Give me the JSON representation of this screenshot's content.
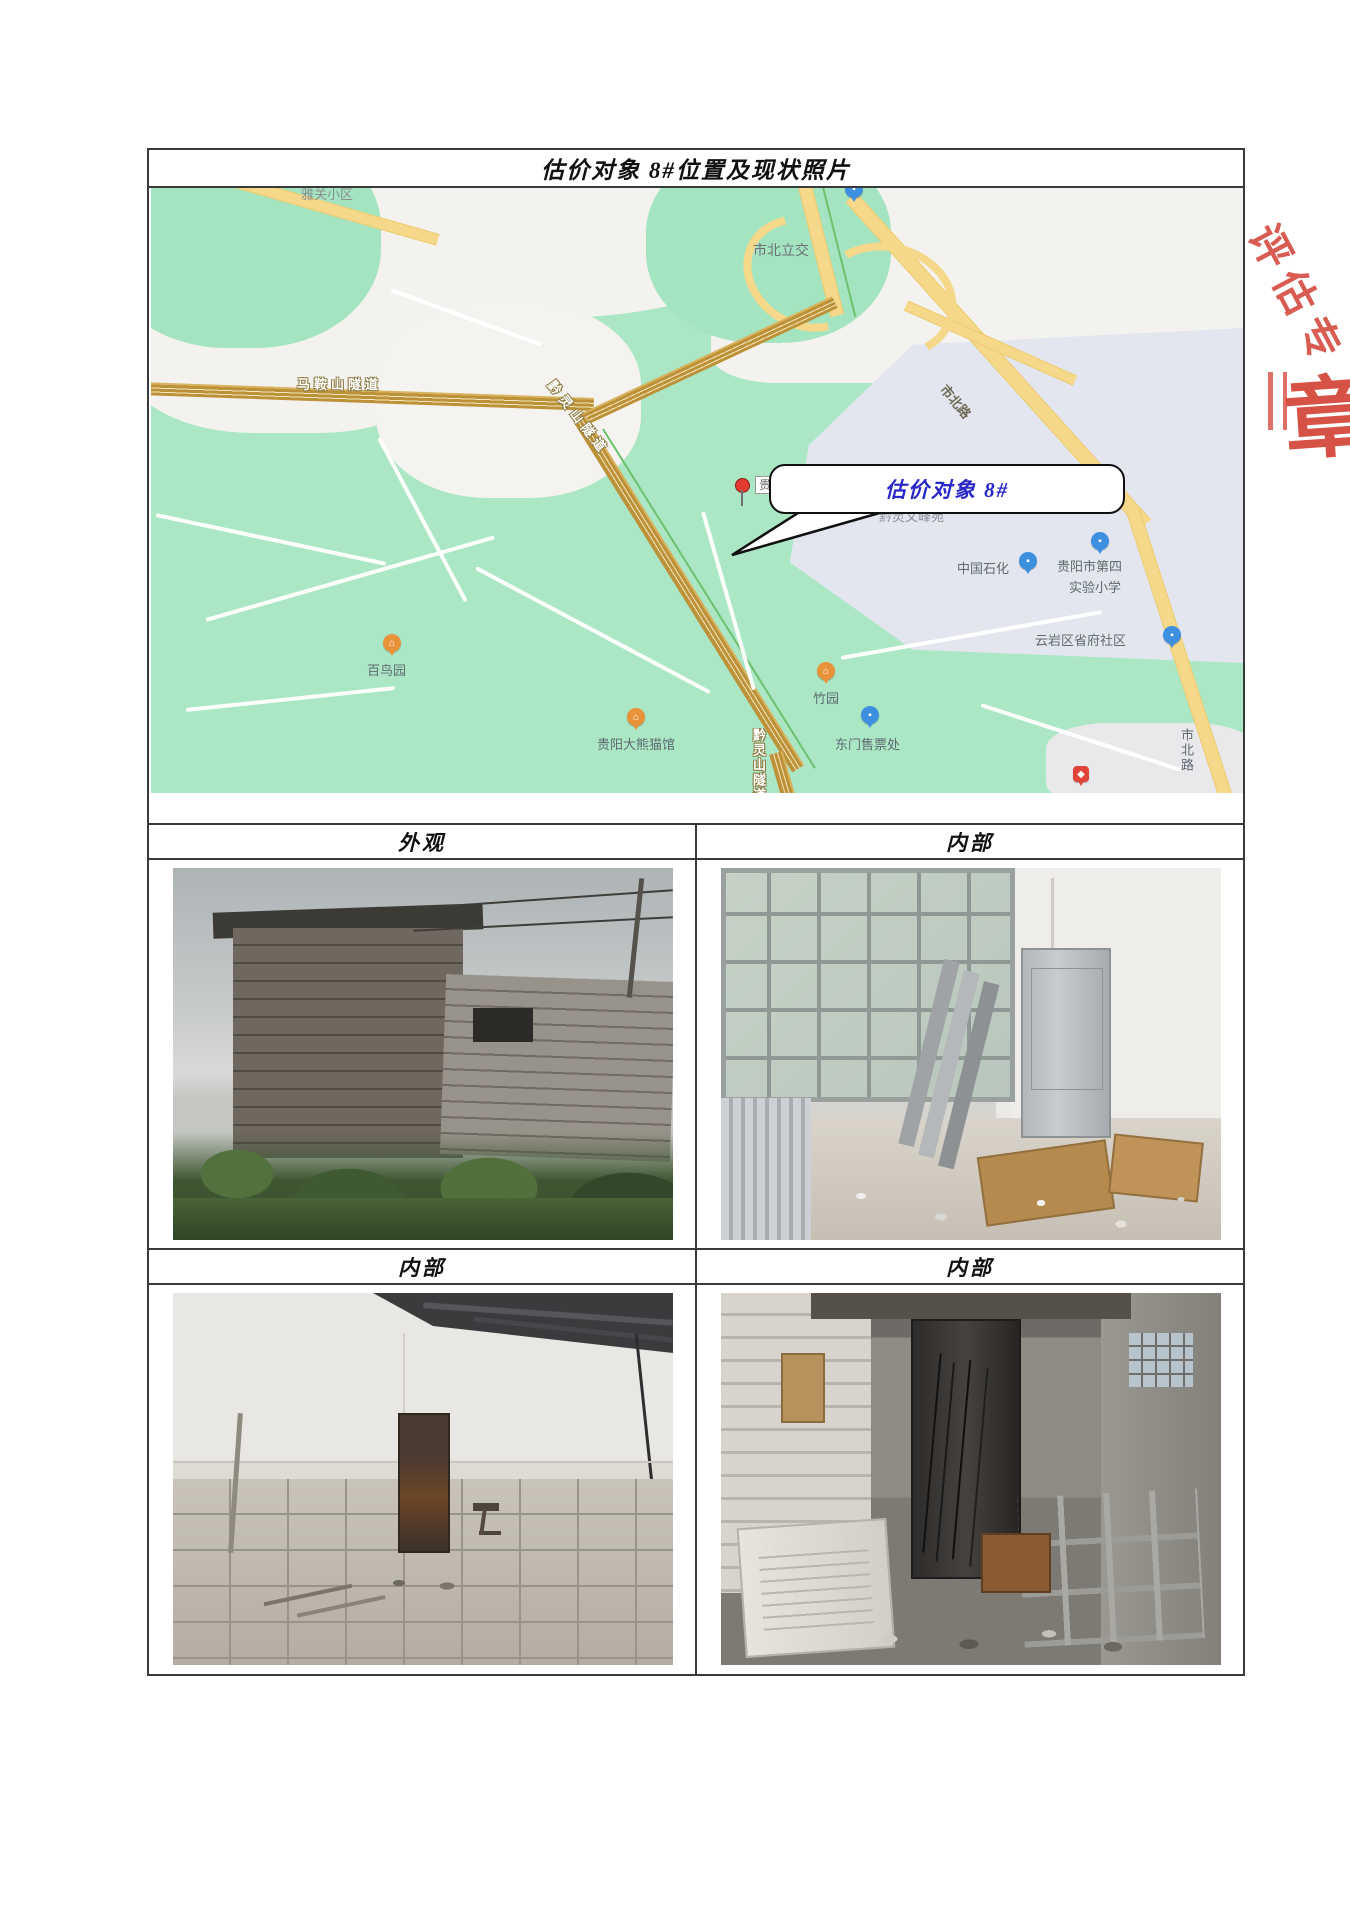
{
  "page": {
    "title": "估价对象 8#位置及现状照片"
  },
  "map": {
    "callout_text": "估价对象 8#",
    "pin_partial_label": "贵",
    "labels": {
      "yaguan": "雅关小区",
      "shibei_lijiao": "市北立交",
      "maanshan_tunnel": "马鞍山隧道",
      "qianlingshan_tunnel": "黔灵山隧道",
      "shibei_road_upper": "市北路",
      "qianling_wenfengyuan": "黔灵文峰苑",
      "sinopec": "中国石化",
      "school_line1": "贵阳市第四",
      "school_line2": "实验小学",
      "shengfu_community": "云岩区省府社区",
      "bainiaoyuan": "百鸟园",
      "zhuyuan": "竹园",
      "panda_house": "贵阳大熊猫馆",
      "east_gate_ticket": "东门售票处",
      "qianlingshan_tunnel_vertical": "黔灵山隧道",
      "shibei_road_lower": "市北路"
    },
    "icons": {
      "park_icon_glyph": "⌂",
      "poi_icon_glyph": "▪",
      "badge_icon_glyph": "◆"
    }
  },
  "sections": {
    "header1_left": "外观",
    "header1_right": "内部",
    "header2_left": "内部",
    "header2_right": "内部"
  },
  "stamp": {
    "fragment_top": "评估专",
    "fragment_bottom": "章"
  },
  "colors": {
    "callout_blue": "#2a28c8",
    "stamp_red": "#cf3428",
    "map_green": "#abe7c5",
    "road_yellow": "#f6d88a",
    "road_brown": "#bd9138"
  }
}
